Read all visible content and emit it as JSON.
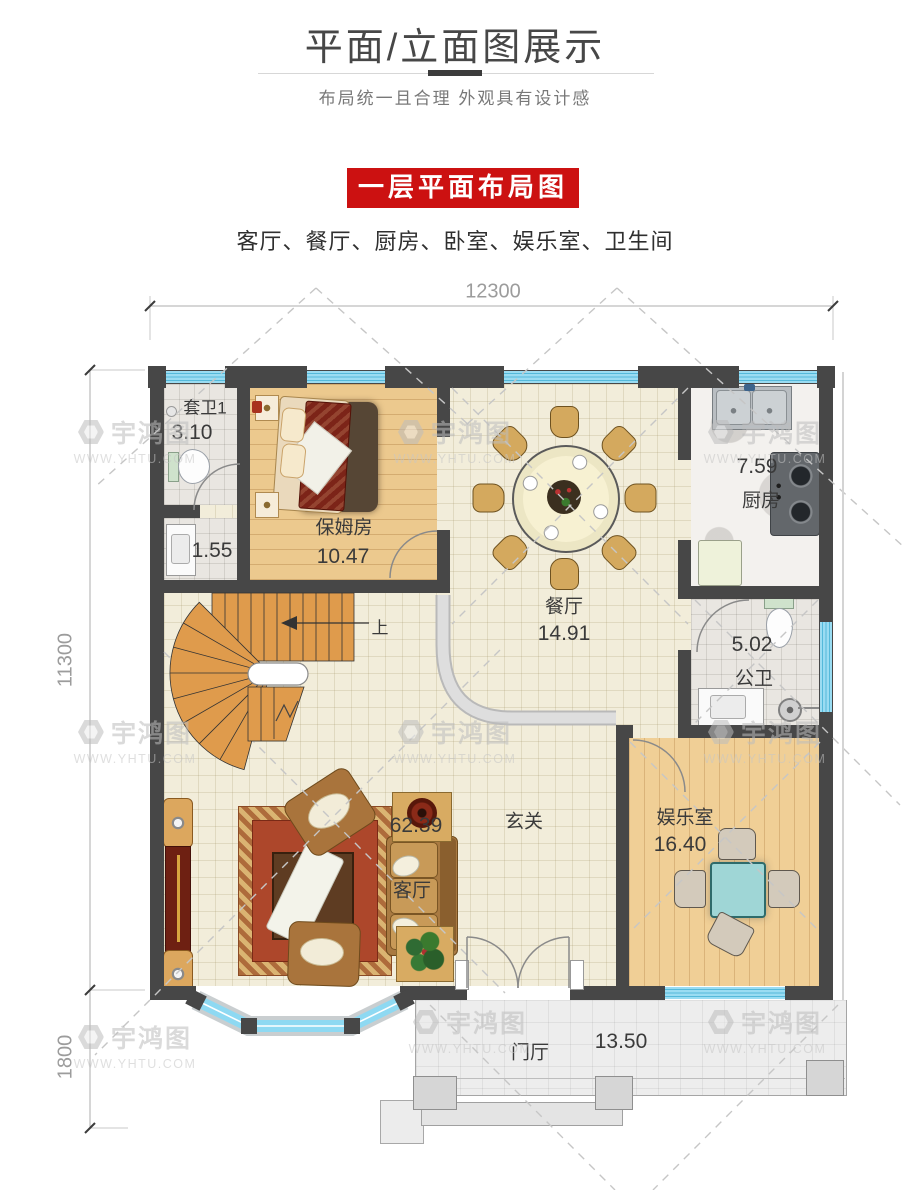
{
  "header": {
    "title": "平面/立面图展示",
    "subtitle": "布局统一且合理  外观具有设计感"
  },
  "section": {
    "banner": "一层平面布局图",
    "rooms_line": "客厅、餐厅、厨房、卧室、娱乐室、卫生间"
  },
  "dimensions": {
    "top_width": "12300",
    "side_height": "11300",
    "porch_height": "1800"
  },
  "rooms": {
    "ensuite": {
      "name": "套卫1",
      "area": "3.10"
    },
    "wash": {
      "area": "1.55"
    },
    "nanny": {
      "name": "保姆房",
      "area": "10.47"
    },
    "dining": {
      "name": "餐厅",
      "area": "14.91"
    },
    "kitchen": {
      "name": "厨房",
      "area": "7.59"
    },
    "bath": {
      "name": "公卫",
      "area": "5.02"
    },
    "game": {
      "name": "娱乐室",
      "area": "16.40"
    },
    "living": {
      "name": "客厅",
      "area": "62.39"
    },
    "foyer": {
      "name": "玄关"
    },
    "porch": {
      "name": "门厅",
      "area": "13.50"
    }
  },
  "stairs": {
    "up": "上"
  },
  "watermark": {
    "brand": "宇鸿图",
    "site": "WWW.YHTU.COM"
  },
  "colors": {
    "banner_red": "#cc1111",
    "window_blue": "#8ed9f2",
    "wall_dark": "#474747",
    "wood_floor": "#ecc98e",
    "stair_orange": "#df9b4c"
  }
}
